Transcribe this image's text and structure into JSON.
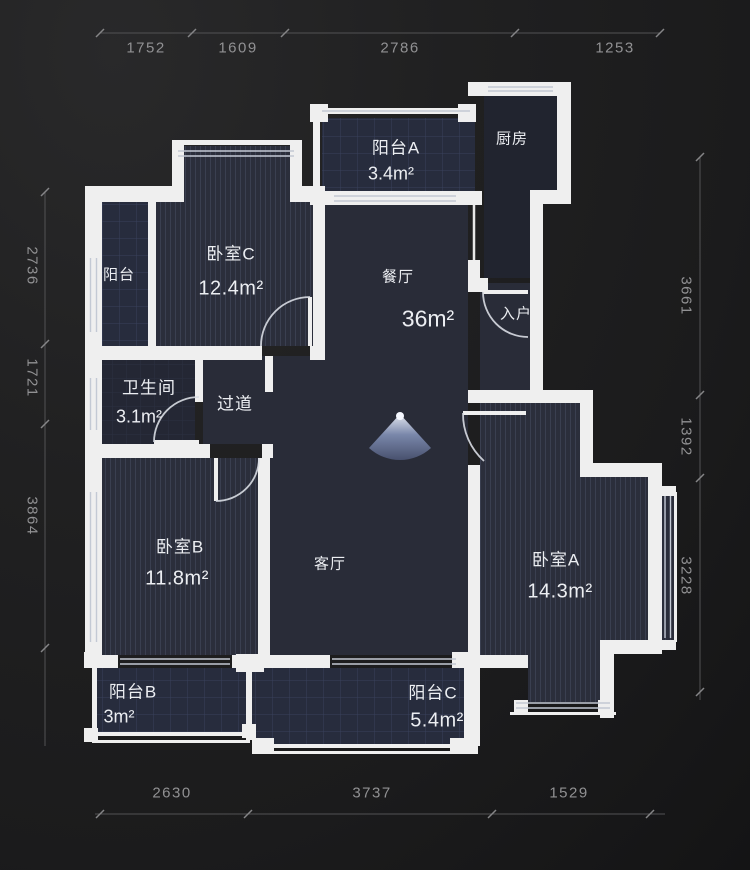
{
  "plan": {
    "title": "apartment-floor-plan",
    "rooms": {
      "balcony_left": {
        "name": "阳台"
      },
      "bedroom_c": {
        "name": "卧室C",
        "area": "12.4m²"
      },
      "balcony_a": {
        "name": "阳台A",
        "area": "3.4m²"
      },
      "kitchen": {
        "name": "厨房"
      },
      "dining": {
        "name": "餐厅",
        "area": "36m²"
      },
      "entry": {
        "name": "入户"
      },
      "bathroom": {
        "name": "卫生间",
        "area": "3.1m²"
      },
      "hallway": {
        "name": "过道"
      },
      "bedroom_b": {
        "name": "卧室B",
        "area": "11.8m²"
      },
      "living": {
        "name": "客厅"
      },
      "bedroom_a": {
        "name": "卧室A",
        "area": "14.3m²"
      },
      "balcony_b": {
        "name": "阳台B",
        "area": "3m²"
      },
      "balcony_c": {
        "name": "阳台C",
        "area": "5.4m²"
      }
    },
    "dimensions": {
      "top": [
        "1752",
        "1609",
        "2786",
        "1253"
      ],
      "bottom": [
        "2630",
        "3737",
        "1529"
      ],
      "left": [
        "2736",
        "1721",
        "3864"
      ],
      "right": [
        "3661",
        "1392",
        "3228"
      ]
    },
    "colors": {
      "wall": "#efefef",
      "background": "#1d1d1f",
      "room_fill": "#292c38",
      "bedroom_fill": "#2b2e3b",
      "balcony_fill": "#272c3d",
      "kitchen_fill": "#21242f",
      "dimension_text": "#919193",
      "label_text": "#eceef2",
      "door_arc": "#d8dce3",
      "view_cone": "#8fa0c6"
    }
  }
}
